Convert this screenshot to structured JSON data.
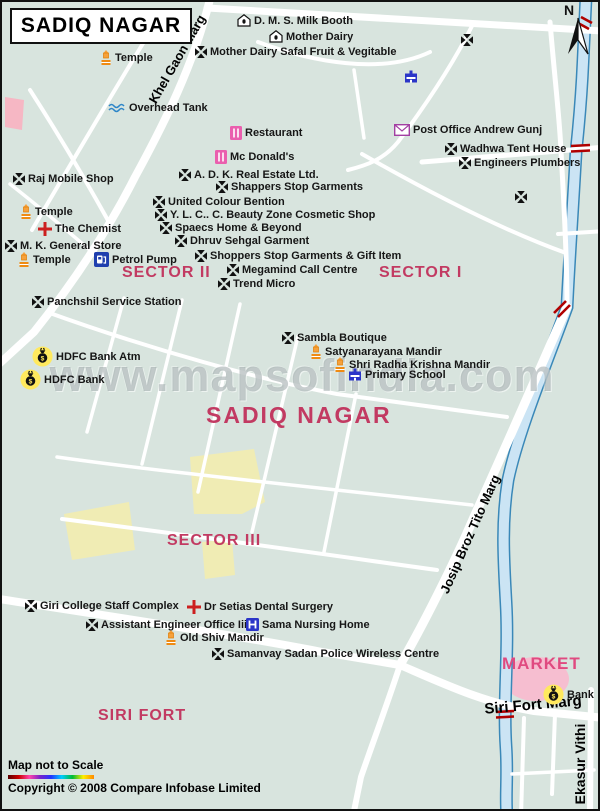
{
  "title": "SADIQ NAGAR",
  "north_label": "N",
  "watermark": "www.mapsofindia.com",
  "footer": {
    "scale_note": "Map not to Scale",
    "copyright": "Copyright © 2008 Compare Infobase Limited"
  },
  "colors": {
    "background": "#d8e4de",
    "road": "#ffffff",
    "river_fill": "#cbe4f4",
    "river_edge": "#3a88b8",
    "area_label": "#c23a62",
    "market_label": "#e04a80",
    "park_yellow": "#f0ecb4",
    "pink_zone": "#f6b7c4",
    "rail_marker": "#b00000"
  },
  "area_labels": [
    {
      "text": "SECTOR II",
      "x": 120,
      "y": 262,
      "size": 16
    },
    {
      "text": "SECTOR I",
      "x": 377,
      "y": 262,
      "size": 16
    },
    {
      "text": "SECTOR III",
      "x": 165,
      "y": 530,
      "size": 16
    },
    {
      "text": "SIRI FORT",
      "x": 96,
      "y": 705,
      "size": 16
    },
    {
      "text": "MARKET",
      "x": 500,
      "y": 652,
      "size": 17,
      "color": "#e04a80"
    },
    {
      "text": "SADIQ NAGAR",
      "x": 204,
      "y": 400,
      "size": 23
    }
  ],
  "road_labels": [
    {
      "text": "Khel Gaon Marg",
      "x": 175,
      "y": 57,
      "rotation": -60,
      "size": 13
    },
    {
      "text": "Josip Broz Tito Marg",
      "x": 468,
      "y": 532,
      "rotation": -66,
      "size": 13
    },
    {
      "text": "Siri Fort Marg",
      "x": 531,
      "y": 703,
      "rotation": -5,
      "size": 15
    },
    {
      "text": "Ekasur Vithi",
      "x": 578,
      "y": 762,
      "rotation": -90,
      "size": 14
    }
  ],
  "pois": [
    {
      "icon": "house",
      "label": "D. M. S. Milk Booth",
      "x": 235,
      "y": 12
    },
    {
      "icon": "house",
      "label": "Mother Dairy",
      "x": 267,
      "y": 28
    },
    {
      "icon": "cross",
      "label": "Mother Dairy Safal Fruit & Vegitable",
      "x": 193,
      "y": 44
    },
    {
      "icon": "temple",
      "label": "Temple",
      "x": 98,
      "y": 48
    },
    {
      "icon": "waves",
      "label": "Overhead Tank",
      "x": 106,
      "y": 100
    },
    {
      "icon": "restaurant",
      "label": "Restaurant",
      "x": 228,
      "y": 124
    },
    {
      "icon": "restaurant",
      "label": "Mc Donald's",
      "x": 213,
      "y": 148
    },
    {
      "icon": "cross",
      "label": "A. D. K. Real Estate Ltd.",
      "x": 177,
      "y": 167
    },
    {
      "icon": "cross",
      "label": "Shappers Stop Garments",
      "x": 214,
      "y": 179
    },
    {
      "icon": "cross",
      "label": "United Colour Bention",
      "x": 151,
      "y": 194
    },
    {
      "icon": "cross",
      "label": "Y. L. C.. C. Beauty Zone Cosmetic Shop",
      "x": 153,
      "y": 207
    },
    {
      "icon": "cross",
      "label": "Spaecs Home & Beyond",
      "x": 158,
      "y": 220
    },
    {
      "icon": "cross",
      "label": "Dhruv Sehgal Garment",
      "x": 173,
      "y": 233
    },
    {
      "icon": "cross",
      "label": "Shoppers Stop Garments & Gift Item",
      "x": 193,
      "y": 248
    },
    {
      "icon": "cross",
      "label": "Megamind Call Centre",
      "x": 225,
      "y": 262
    },
    {
      "icon": "cross",
      "label": "Trend Micro",
      "x": 216,
      "y": 276
    },
    {
      "icon": "cross",
      "label": "Raj Mobile Shop",
      "x": 11,
      "y": 171
    },
    {
      "icon": "temple",
      "label": "Temple",
      "x": 18,
      "y": 202
    },
    {
      "icon": "redcross",
      "label": "The Chemist",
      "x": 36,
      "y": 220
    },
    {
      "icon": "cross",
      "label": "M. K. General Store",
      "x": 3,
      "y": 238
    },
    {
      "icon": "temple",
      "label": "Temple",
      "x": 16,
      "y": 250
    },
    {
      "icon": "petrol",
      "label": "Petrol Pump",
      "x": 92,
      "y": 250
    },
    {
      "icon": "cross",
      "label": "Panchshil Service Station",
      "x": 30,
      "y": 294
    },
    {
      "icon": "bank",
      "label": "HDFC Bank Atm",
      "x": 30,
      "y": 344
    },
    {
      "icon": "bank",
      "label": "HDFC Bank",
      "x": 18,
      "y": 367
    },
    {
      "icon": "cross",
      "label": "Sambla Boutique",
      "x": 280,
      "y": 330
    },
    {
      "icon": "temple",
      "label": "Satyanarayana Mandir",
      "x": 308,
      "y": 342
    },
    {
      "icon": "temple",
      "label": "Shri Radha Krishna Mandir",
      "x": 332,
      "y": 355
    },
    {
      "icon": "school",
      "label": "Primary School",
      "x": 346,
      "y": 366
    },
    {
      "icon": "building",
      "label": "",
      "x": 402,
      "y": 68
    },
    {
      "icon": "postoffice",
      "label": "Post Office Andrew Gunj",
      "x": 392,
      "y": 122
    },
    {
      "icon": "cross",
      "label": "Wadhwa Tent House",
      "x": 443,
      "y": 141
    },
    {
      "icon": "cross",
      "label": "Engineers Plumbers",
      "x": 457,
      "y": 155
    },
    {
      "icon": "cross",
      "label": "",
      "x": 513,
      "y": 189
    },
    {
      "icon": "cross",
      "label": "",
      "x": 459,
      "y": 32
    },
    {
      "icon": "cross",
      "label": "Giri College Staff Complex",
      "x": 23,
      "y": 598
    },
    {
      "icon": "redcross",
      "label": "Dr Setias Dental Surgery",
      "x": 185,
      "y": 598
    },
    {
      "icon": "cross",
      "label": "Assistant Engineer Office Iii",
      "x": 84,
      "y": 617
    },
    {
      "icon": "hospital",
      "label": "Sama Nursing Home",
      "x": 244,
      "y": 616
    },
    {
      "icon": "temple",
      "label": "Old Shiv Mandir",
      "x": 163,
      "y": 628
    },
    {
      "icon": "cross",
      "label": "Samanvay Sadan Police Wireless Centre",
      "x": 210,
      "y": 646
    },
    {
      "icon": "bank",
      "label": "Bank",
      "x": 541,
      "y": 682
    }
  ]
}
